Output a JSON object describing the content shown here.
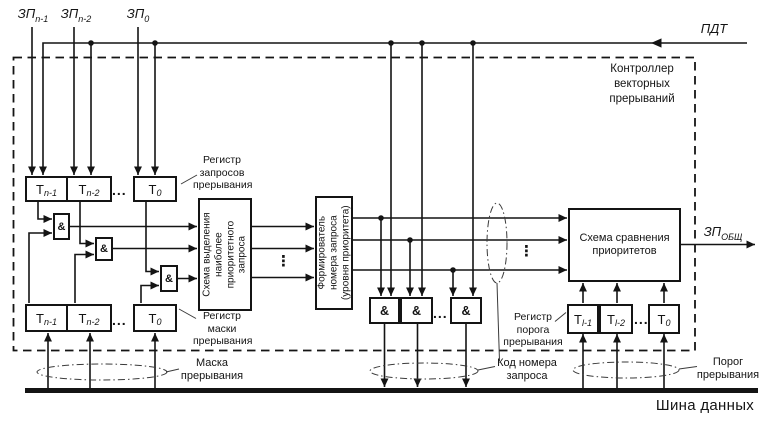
{
  "controller_title": "Контроллер\nвекторных\nпрерываний",
  "inputs": {
    "zp": [
      {
        "base": "ЗП",
        "sub": "n-1"
      },
      {
        "base": "ЗП",
        "sub": "n-2"
      },
      {
        "base": "ЗП",
        "sub": "0"
      }
    ],
    "pdt": "ПДТ"
  },
  "output": {
    "base": "ЗП",
    "sub": "ОБЩ"
  },
  "request_register": {
    "label": "Регистр\nзапросов\nпрерывания",
    "cells": [
      {
        "base": "Т",
        "sub": "n-1"
      },
      {
        "base": "Т",
        "sub": "n-2"
      },
      {
        "base": "Т",
        "sub": "0"
      }
    ]
  },
  "mask_register": {
    "label": "Регистр\nмаски\nпрерывания",
    "cells": [
      {
        "base": "Т",
        "sub": "n-1"
      },
      {
        "base": "Т",
        "sub": "n-2"
      },
      {
        "base": "Т",
        "sub": "0"
      }
    ]
  },
  "threshold_register": {
    "label": "Регистр\nпорога\nпрерывания",
    "cells": [
      {
        "base": "Т",
        "sub": "l-1"
      },
      {
        "base": "Т",
        "sub": "l-2"
      },
      {
        "base": "Т",
        "sub": "0"
      }
    ]
  },
  "blocks": {
    "selector": "Схема выделения\nнаиболее\nприоритетного\nзапроса",
    "former": "Формирователь\nномера запроса\n(уровня приоритета)",
    "comparator": "Схема сравнения\nприоритетов"
  },
  "gate_symbol": "&",
  "ellipsis_h": "...",
  "ellipsis_v": "⋮",
  "bus": {
    "label": "Шина данных"
  },
  "annotations": {
    "mask": "Маска\nпрерывания",
    "code": "Код номера\nзапроса",
    "threshold": "Порог\nпрерывания"
  },
  "colors": {
    "line": "#141414",
    "thin": "#3a3a3a",
    "background": "#ffffff"
  }
}
